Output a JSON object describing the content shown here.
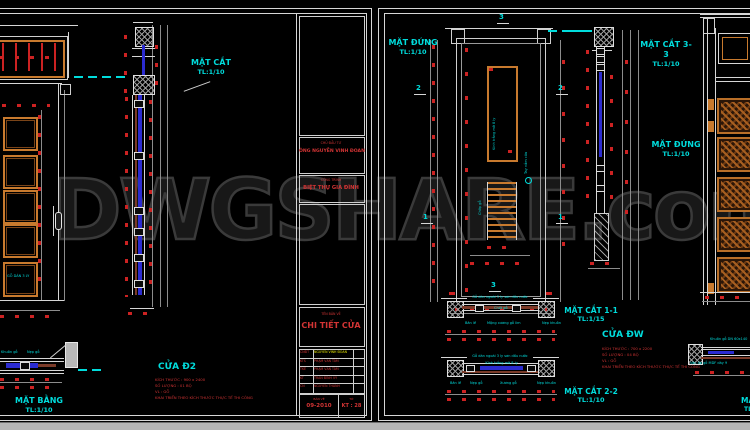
{
  "watermark": "DWGSHARE.com",
  "left_sheet": {
    "section_label": {
      "title": "MẶT CẮT",
      "scale": "TL:1/10"
    },
    "plan_label": {
      "title": "MẶT BẰNG",
      "scale": "TL:1/10"
    },
    "door": {
      "title": "CỬA Đ2",
      "notes": [
        "KÍCH THƯỚC : 900 x 2400",
        "SỐ LƯỢNG : 01 BỘ",
        "VL : GỖ",
        "KHAI TRIỂN THEO KÍCH THƯỚC THỰC TẾ THI CÔNG"
      ]
    },
    "panel_note": "GỖ DÁN 3 LY",
    "plan_notes": [
      "Khuôn gỗ",
      "Nẹp gỗ"
    ],
    "titleblock": {
      "owner_label": "CHỦ ĐẦU TƯ",
      "owner_name": "ÔNG NGUYỄN VINH ĐOAN",
      "project_label": "CÔNG TRÌNH",
      "project_name": "BIỆT THỰ GIA ĐÌNH",
      "drawing_label": "TÊN BẢN VẼ",
      "drawing_name": "CHI TIẾT CỬA",
      "staff": [
        {
          "role": "CNĐT",
          "name": "NGUYỄN VĨNH ĐOAN"
        },
        {
          "role": "KTS",
          "name": "PHẠM VĂN TÂM"
        },
        {
          "role": "TKẾ",
          "name": "PHẠM VĂN TÂM"
        },
        {
          "role": "KT",
          "name": "TRẦN ĐÌNH VỸ"
        },
        {
          "role": "CN",
          "name": "NGUYỄN THÀNH"
        }
      ],
      "date_label": "BẢN VẼ",
      "date": "09-2010",
      "sheet_label": "TỜ",
      "sheet_no": "KT : 28"
    }
  },
  "right_sheet": {
    "elev_label": {
      "title": "MẶT ĐỨNG",
      "scale": "TL:1/10"
    },
    "section33_label": {
      "title": "MẶT CẮT 3-3",
      "scale": "TL:1/10"
    },
    "elev2_label": {
      "title": "MẶT ĐỨNG",
      "scale": "TL:1/10"
    },
    "section11_label": {
      "title": "MẶT CẮT 1-1",
      "scale": "TL:1/15"
    },
    "section22_label": {
      "title": "MẶT CẮT 2-2",
      "scale": "TL:1/10"
    },
    "door": {
      "title": "CỬA ĐW",
      "notes": [
        "KÍCH THƯỚC : 700 x 2200",
        "SỐ LƯỢNG : 04 BỘ",
        "VL : GỖ",
        "KHAI TRIỂN THEO KÍCH THƯỚC THỰC TẾ THI CÔNG"
      ]
    },
    "markers": {
      "m1": "1",
      "m2": "2",
      "m3": "3"
    },
    "glass_note": "Kính trắng mờ 8 ly",
    "louver_note": "Chớp gỗ",
    "handle_note": "Tay nắm cửa",
    "s11": {
      "top": "Gỗ dán ngoài 3 ly sơn dầu nước",
      "mid": "Chốt gỗ",
      "b1": "Bản lề",
      "b2": "Mộng xương gỗ lim",
      "b3": "Nẹp khuôn"
    },
    "s22": {
      "top": "Gỗ dán ngoài 3 ly sơn dầu nước",
      "mid": "Kính trắng mờ 8 ly",
      "b1": "Bản lề",
      "b2": "Nẹp gỗ",
      "b3": "Xương gỗ",
      "b4": "Nẹp khuôn"
    },
    "detail": {
      "top": "Khuôn gỗ DN 60x140",
      "bottom": "Ván ốp gỗ MDF dày 9",
      "cut_title": "MẶT",
      "cut_scale": "TL"
    }
  }
}
